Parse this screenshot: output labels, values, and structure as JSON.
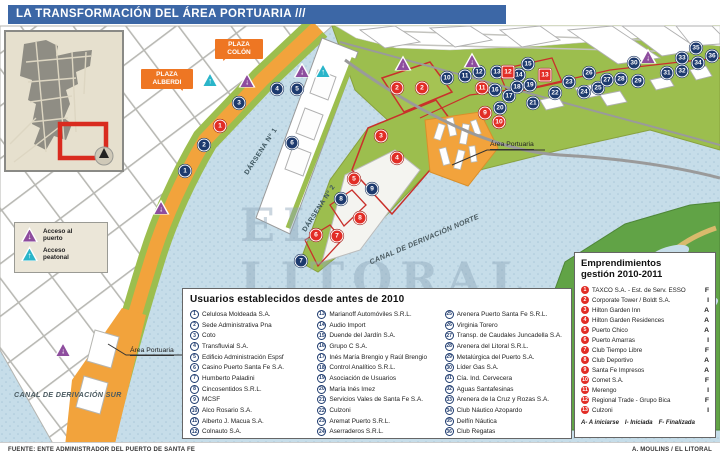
{
  "title": "LA TRANSFORMACIÓN DEL ÁREA PORTUARIA ///",
  "colors": {
    "title_bar": "#3c67a6",
    "water": "#c6dde9",
    "land_green": "#9cbe4e",
    "road_orange": "#f2a33c",
    "island_green": "#61a346",
    "marker_blue": "#1d3a6e",
    "marker_red": "#e22d26",
    "access_port_purple": "#8e4d9e",
    "access_ped_cyan": "#2ab5c9",
    "callout_orange": "#ee7623"
  },
  "map_labels": {
    "plaza_colon": "PLAZA COLÓN",
    "plaza_alberdi": "PLAZA ALBERDI",
    "darsena_1": "DÁRSENA Nº 1",
    "darsena_2": "DÁRSENA Nº 2",
    "canal_norte": "CANAL DE DERIVACIÓN NORTE",
    "canal_sur": "CANAL DE DERIVACIÓN SUR",
    "area_portuaria_right": "Área Portuaria",
    "area_portuaria_left": "Área Portuaria",
    "watermark": "EL LITORAL"
  },
  "access_legend": {
    "port": "Acceso al puerto",
    "pedestrian": "Acceso peatonal",
    "port_icon": "port-access-triangle-icon",
    "pedestrian_icon": "pedestrian-access-triangle-icon"
  },
  "usuarios_panel": {
    "title": "Usuarios establecidos desde antes de 2010",
    "items": [
      {
        "n": 1,
        "name": "Celulosa Moldeada S.A."
      },
      {
        "n": 2,
        "name": "Sede Administrativa Pna"
      },
      {
        "n": 3,
        "name": "Coto"
      },
      {
        "n": 4,
        "name": "Transfluvial S.A."
      },
      {
        "n": 5,
        "name": "Edificio Administración Espsf"
      },
      {
        "n": 6,
        "name": "Casino Puerto Santa Fe S.A."
      },
      {
        "n": 7,
        "name": "Humberto Paladini"
      },
      {
        "n": 8,
        "name": "Cincosentidos S.R.L."
      },
      {
        "n": 9,
        "name": "MCSF"
      },
      {
        "n": 10,
        "name": "Alco Rosario S.A."
      },
      {
        "n": 11,
        "name": "Alberto J. Macua S.A."
      },
      {
        "n": 12,
        "name": "Colnauto S.A."
      },
      {
        "n": 13,
        "name": "Marianoff Automóviles S.R.L."
      },
      {
        "n": 14,
        "name": "Audio Import"
      },
      {
        "n": 15,
        "name": "Duende del Jardín S.A."
      },
      {
        "n": 16,
        "name": "Grupo C S.A."
      },
      {
        "n": 17,
        "name": "Inés María Brengio y Raúl Brengio"
      },
      {
        "n": 18,
        "name": "Control Analítico S.R.L."
      },
      {
        "n": 19,
        "name": "Asociación de Usuarios"
      },
      {
        "n": 20,
        "name": "María Inés Imez"
      },
      {
        "n": 21,
        "name": "Servicios Vales de Santa Fe S.A."
      },
      {
        "n": 22,
        "name": "Culzoni"
      },
      {
        "n": 23,
        "name": "Aremat Puerto S.R.L."
      },
      {
        "n": 24,
        "name": "Aserraderos S.R.L."
      },
      {
        "n": 25,
        "name": "Arenera Puerto Santa Fe S.R.L."
      },
      {
        "n": 26,
        "name": "Virginia Torero"
      },
      {
        "n": 27,
        "name": "Transp. de Caudales Juncadella S.A."
      },
      {
        "n": 28,
        "name": "Arenera del Litoral S.R.L."
      },
      {
        "n": 29,
        "name": "Metalúrgica del Puerto S.A."
      },
      {
        "n": 30,
        "name": "Líder Gas S.A."
      },
      {
        "n": 31,
        "name": "Cía. Ind. Cervecera"
      },
      {
        "n": 32,
        "name": "Aguas Santafesinas"
      },
      {
        "n": 33,
        "name": "Arenera de la Cruz y Rozas S.A."
      },
      {
        "n": 34,
        "name": "Club Náutico Azopardo"
      },
      {
        "n": 35,
        "name": "Delfín Náutica"
      },
      {
        "n": 36,
        "name": "Club Regatas"
      }
    ]
  },
  "emprendimientos_panel": {
    "title": "Emprendimientos gestión 2010-2011",
    "items": [
      {
        "n": 1,
        "name": "TAXCO S.A. - Est. de Serv. ESSO",
        "status": "F"
      },
      {
        "n": 2,
        "name": "Corporate Tower / Boldt S.A.",
        "status": "I"
      },
      {
        "n": 3,
        "name": "Hilton Garden Inn",
        "status": "A"
      },
      {
        "n": 4,
        "name": "Hilton Garden Residences",
        "status": "A"
      },
      {
        "n": 5,
        "name": "Puerto Chico",
        "status": "A"
      },
      {
        "n": 6,
        "name": "Puerto Amarras",
        "status": "I"
      },
      {
        "n": 7,
        "name": "Club Tiempo Libre",
        "status": "F"
      },
      {
        "n": 8,
        "name": "Club Deportivo",
        "status": "A"
      },
      {
        "n": 9,
        "name": "Santa Fe Impresos",
        "status": "A"
      },
      {
        "n": 10,
        "name": "Comet S.A.",
        "status": "F"
      },
      {
        "n": 11,
        "name": "Merengo",
        "status": "I"
      },
      {
        "n": 12,
        "name": "Regional Trade - Grupo Bica",
        "status": "F"
      },
      {
        "n": 13,
        "name": "Culzoni",
        "status": "I"
      }
    ],
    "status_legend": [
      "A- A iniciarse",
      "I- Iniciada",
      "F- Finalizada"
    ]
  },
  "markers": {
    "usuarios": [
      {
        "n": 1,
        "x": 185,
        "y": 171
      },
      {
        "n": 2,
        "x": 204,
        "y": 145
      },
      {
        "n": 3,
        "x": 239,
        "y": 103
      },
      {
        "n": 4,
        "x": 277,
        "y": 89
      },
      {
        "n": 5,
        "x": 297,
        "y": 89
      },
      {
        "n": 6,
        "x": 292,
        "y": 143
      },
      {
        "n": 7,
        "x": 301,
        "y": 261
      },
      {
        "n": 8,
        "x": 341,
        "y": 199
      },
      {
        "n": 9,
        "x": 372,
        "y": 189
      },
      {
        "n": 10,
        "x": 447,
        "y": 78
      },
      {
        "n": 11,
        "x": 465,
        "y": 76
      },
      {
        "n": 12,
        "x": 479,
        "y": 72
      },
      {
        "n": 13,
        "x": 497,
        "y": 72
      },
      {
        "n": 14,
        "x": 519,
        "y": 75
      },
      {
        "n": 15,
        "x": 528,
        "y": 64
      },
      {
        "n": 16,
        "x": 495,
        "y": 90
      },
      {
        "n": 17,
        "x": 509,
        "y": 96
      },
      {
        "n": 18,
        "x": 517,
        "y": 87
      },
      {
        "n": 19,
        "x": 530,
        "y": 85
      },
      {
        "n": 20,
        "x": 500,
        "y": 108
      },
      {
        "n": 21,
        "x": 533,
        "y": 103
      },
      {
        "n": 22,
        "x": 555,
        "y": 93
      },
      {
        "n": 23,
        "x": 569,
        "y": 82
      },
      {
        "n": 24,
        "x": 584,
        "y": 92
      },
      {
        "n": 25,
        "x": 598,
        "y": 88
      },
      {
        "n": 26,
        "x": 589,
        "y": 73
      },
      {
        "n": 27,
        "x": 607,
        "y": 80
      },
      {
        "n": 28,
        "x": 621,
        "y": 79
      },
      {
        "n": 29,
        "x": 638,
        "y": 81
      },
      {
        "n": 30,
        "x": 634,
        "y": 63
      },
      {
        "n": 31,
        "x": 667,
        "y": 73
      },
      {
        "n": 32,
        "x": 682,
        "y": 71
      },
      {
        "n": 33,
        "x": 682,
        "y": 58
      },
      {
        "n": 34,
        "x": 698,
        "y": 63
      },
      {
        "n": 35,
        "x": 696,
        "y": 48
      },
      {
        "n": 36,
        "x": 712,
        "y": 56
      }
    ],
    "emprendimientos": [
      {
        "n": 1,
        "x": 220,
        "y": 126,
        "shape": "circle"
      },
      {
        "n": 2,
        "x": 397,
        "y": 88,
        "shape": "circle"
      },
      {
        "n": 2,
        "x": 422,
        "y": 88,
        "shape": "circle"
      },
      {
        "n": 3,
        "x": 381,
        "y": 136,
        "shape": "circle"
      },
      {
        "n": 4,
        "x": 397,
        "y": 158,
        "shape": "circle"
      },
      {
        "n": 5,
        "x": 354,
        "y": 179,
        "shape": "circle"
      },
      {
        "n": 6,
        "x": 316,
        "y": 235,
        "shape": "circle"
      },
      {
        "n": 7,
        "x": 337,
        "y": 236,
        "shape": "circle"
      },
      {
        "n": 8,
        "x": 360,
        "y": 218,
        "shape": "circle"
      },
      {
        "n": 9,
        "x": 485,
        "y": 113,
        "shape": "circle"
      },
      {
        "n": 10,
        "x": 499,
        "y": 122,
        "shape": "circle"
      },
      {
        "n": 11,
        "x": 482,
        "y": 88,
        "shape": "circle"
      },
      {
        "n": 12,
        "x": 508,
        "y": 72,
        "shape": "square"
      },
      {
        "n": 13,
        "x": 545,
        "y": 75,
        "shape": "square"
      }
    ],
    "port_access": [
      {
        "x": 247,
        "y": 80
      },
      {
        "x": 302,
        "y": 70
      },
      {
        "x": 403,
        "y": 63
      },
      {
        "x": 472,
        "y": 60
      },
      {
        "x": 648,
        "y": 56
      },
      {
        "x": 161,
        "y": 207
      },
      {
        "x": 63,
        "y": 349
      }
    ],
    "ped_access": [
      {
        "x": 210,
        "y": 79
      },
      {
        "x": 323,
        "y": 70
      }
    ]
  },
  "footer": {
    "source": "FUENTE: ENTE ADMINISTRADOR DEL PUERTO DE SANTA FE",
    "credit": "A. MOULINS / EL LITORAL"
  }
}
